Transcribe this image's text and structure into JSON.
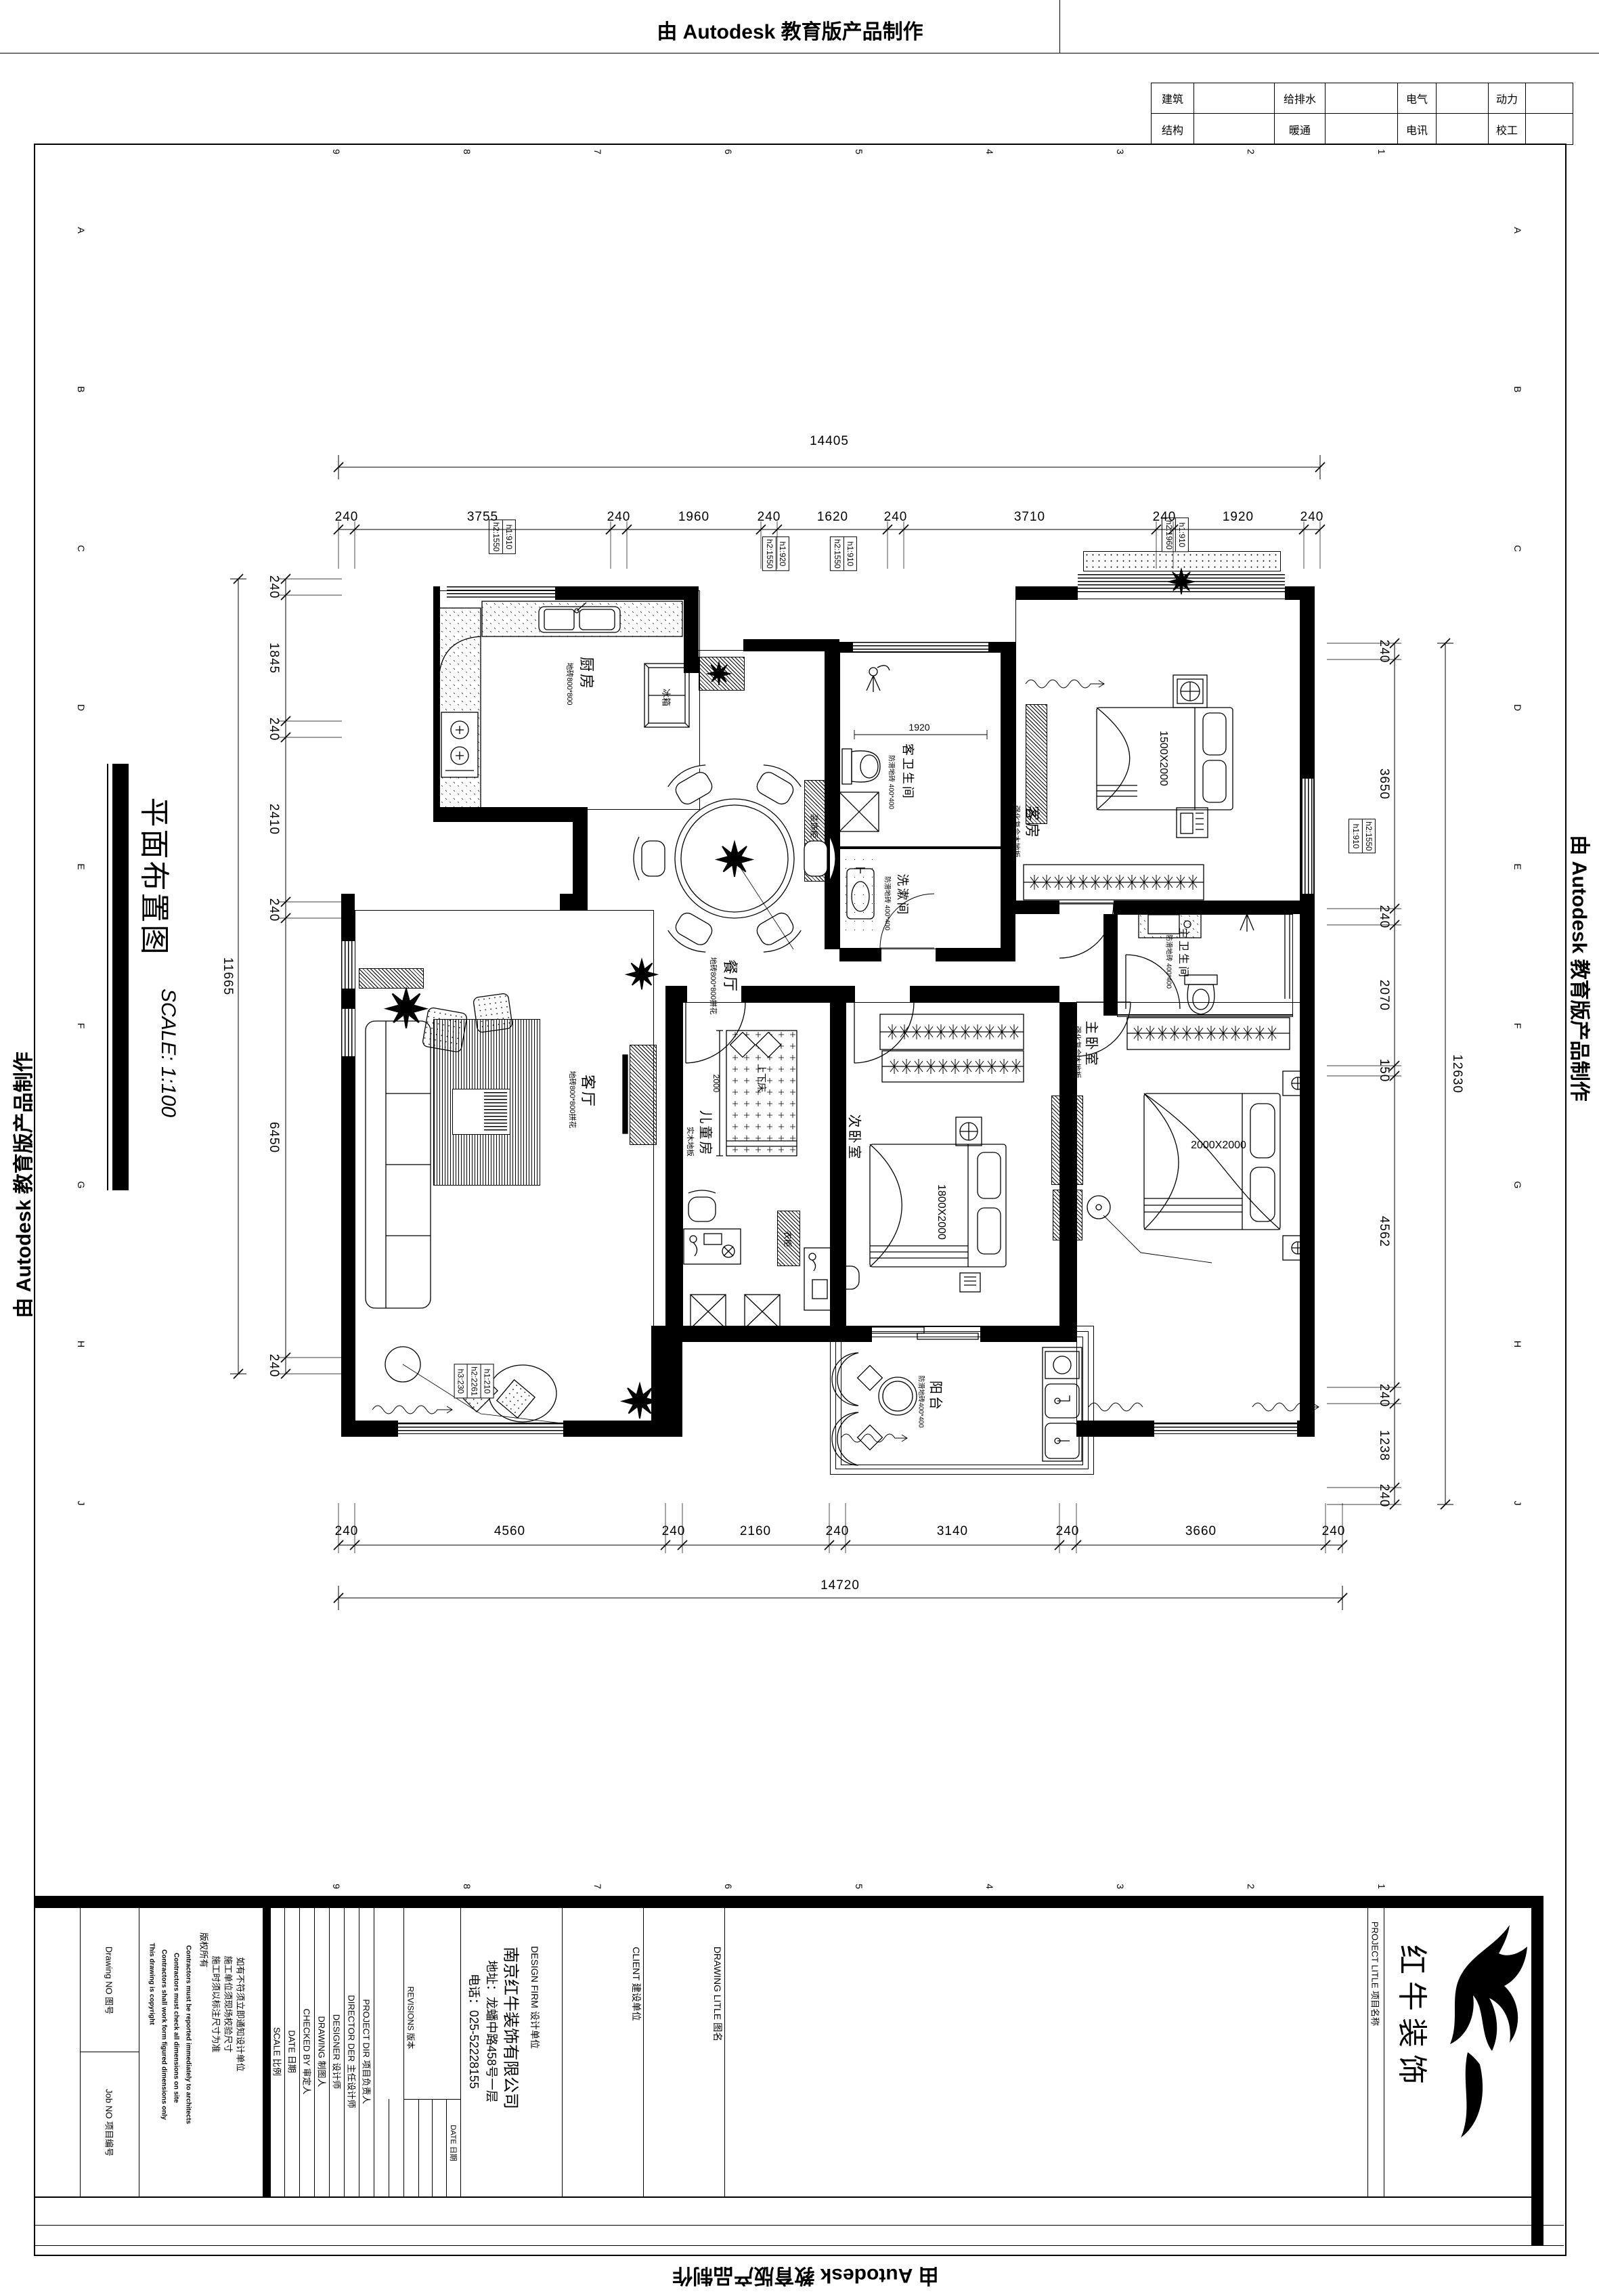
{
  "banners": {
    "top": "由 Autodesk 教育版产品制作",
    "bottom": "由 Autodesk 教育版产品制作",
    "left": "由 Autodesk 教育版产品制作",
    "right": "由 Autodesk 教育版产品制作"
  },
  "discipline_table": {
    "row1": [
      "建筑",
      "给排水",
      "电气",
      "动力"
    ],
    "row2": [
      "结构",
      "暖通",
      "电讯",
      "校工"
    ]
  },
  "grid_refs": {
    "cols": [
      "9",
      "8",
      "7",
      "6",
      "5",
      "4",
      "3",
      "2",
      "1"
    ],
    "rows": [
      "A",
      "B",
      "C",
      "D",
      "E",
      "F",
      "G",
      "H",
      "J"
    ]
  },
  "sheet_title": {
    "name": "平面布置图",
    "scale": "SCALE: 1:100"
  },
  "rooms": {
    "kitchen": {
      "name": "厨房",
      "sub": "地砖800*800"
    },
    "dining": {
      "name": "餐厅",
      "sub": "地砖800*800拼花"
    },
    "living": {
      "name": "客厅",
      "sub": "地砖800*800拼花"
    },
    "guest": {
      "name": "客房",
      "sub": "强化复合木地板"
    },
    "guest_bath": {
      "name": "客卫生间",
      "sub": "防滑地砖 400*400"
    },
    "wash": {
      "name": "洗漱间",
      "sub": "防滑地砖 400*400"
    },
    "children": {
      "name": "儿童房",
      "sub": "实木地板"
    },
    "second": {
      "name": "次卧室",
      "sub": "强化复合木地板"
    },
    "master": {
      "name": "主卧室",
      "sub": "强化复合木地板"
    },
    "master_bath": {
      "name": "主卫生间",
      "sub": "防滑地砖 400*400"
    },
    "balcony": {
      "name": "阳台",
      "sub": "防滑地砖400*400"
    }
  },
  "fixtures": {
    "fridge": "冰箱",
    "bunk": "上下床",
    "wardrobe": "衣柜",
    "deco_cabinet": "装饰柜",
    "bed_guest": "1500X2000",
    "bed_second": "1800X2000",
    "bed_master": "2000X2000",
    "shower_width": "1920",
    "bunk_length": "2000"
  },
  "window_tags": {
    "w1": [
      "h1:910",
      "h2:1550"
    ],
    "w2": [
      "h1:920",
      "h2:1550"
    ],
    "w3": [
      "h1:910",
      "h2:1550"
    ],
    "w4": [
      "h1:910",
      "h2:1960"
    ],
    "w5": [
      "h2:1550",
      "h1:910"
    ],
    "w6": [
      "h1:210",
      "h2:2261",
      "h3:230"
    ]
  },
  "dims": {
    "top": {
      "total": "14405",
      "segments": [
        "240",
        "3755",
        "240",
        "1960",
        "240",
        "1620",
        "240",
        "3710",
        "240",
        "1920",
        "240"
      ]
    },
    "bottom": {
      "total": "14720",
      "segments": [
        "240",
        "4560",
        "240",
        "2160",
        "240",
        "3140",
        "240",
        "3660",
        "240"
      ]
    },
    "left": {
      "total": "11665",
      "segments": [
        "240",
        "1845",
        "240",
        "2410",
        "240",
        "6450",
        "240"
      ]
    },
    "right": {
      "total": "12630",
      "segments": [
        "240",
        "3650",
        "240",
        "2070",
        "150",
        "4562",
        "240",
        "1238",
        "240"
      ]
    }
  },
  "title_block": {
    "drawing_no": "Drawing NO 图号",
    "job_no": "Job NO 项目编号",
    "notes_en": [
      "This drawing is copyright",
      "Contractors shall work form figured dimensions only",
      "Contractors must check all dimensions on site",
      "Contractors must be reported immediately to architects"
    ],
    "notes_cn": [
      "版权所有",
      "施工时须以标注尺寸为准",
      "施工单位须现场校验尺寸",
      "如有不符须立即通知设计单位"
    ],
    "fields": [
      "SCALE 比例",
      "DATE 日期",
      "CHECKED BY 审定人",
      "DRAWING 制图人",
      "DESIGNER 设计师",
      "DIRECTOR DER 主任设计师",
      "PROJECT DIR 项目负责人"
    ],
    "revisions": "REVISIONS 版本",
    "rev_date": "DATE 日期",
    "design_firm_label": "DESIGN FIRM 设计单位",
    "firm_name": "南京红牛装饰有限公司",
    "firm_addr": "地址：龙蟠中路458号一层",
    "firm_tel": "电话：025-52228155",
    "client_label": "CLIENT 建设单位",
    "drawing_title_label": "DRAWING LITLE 图名",
    "project_title_label": "PROJECT LITLE 项目名称",
    "logo_text": "红牛装饰"
  }
}
